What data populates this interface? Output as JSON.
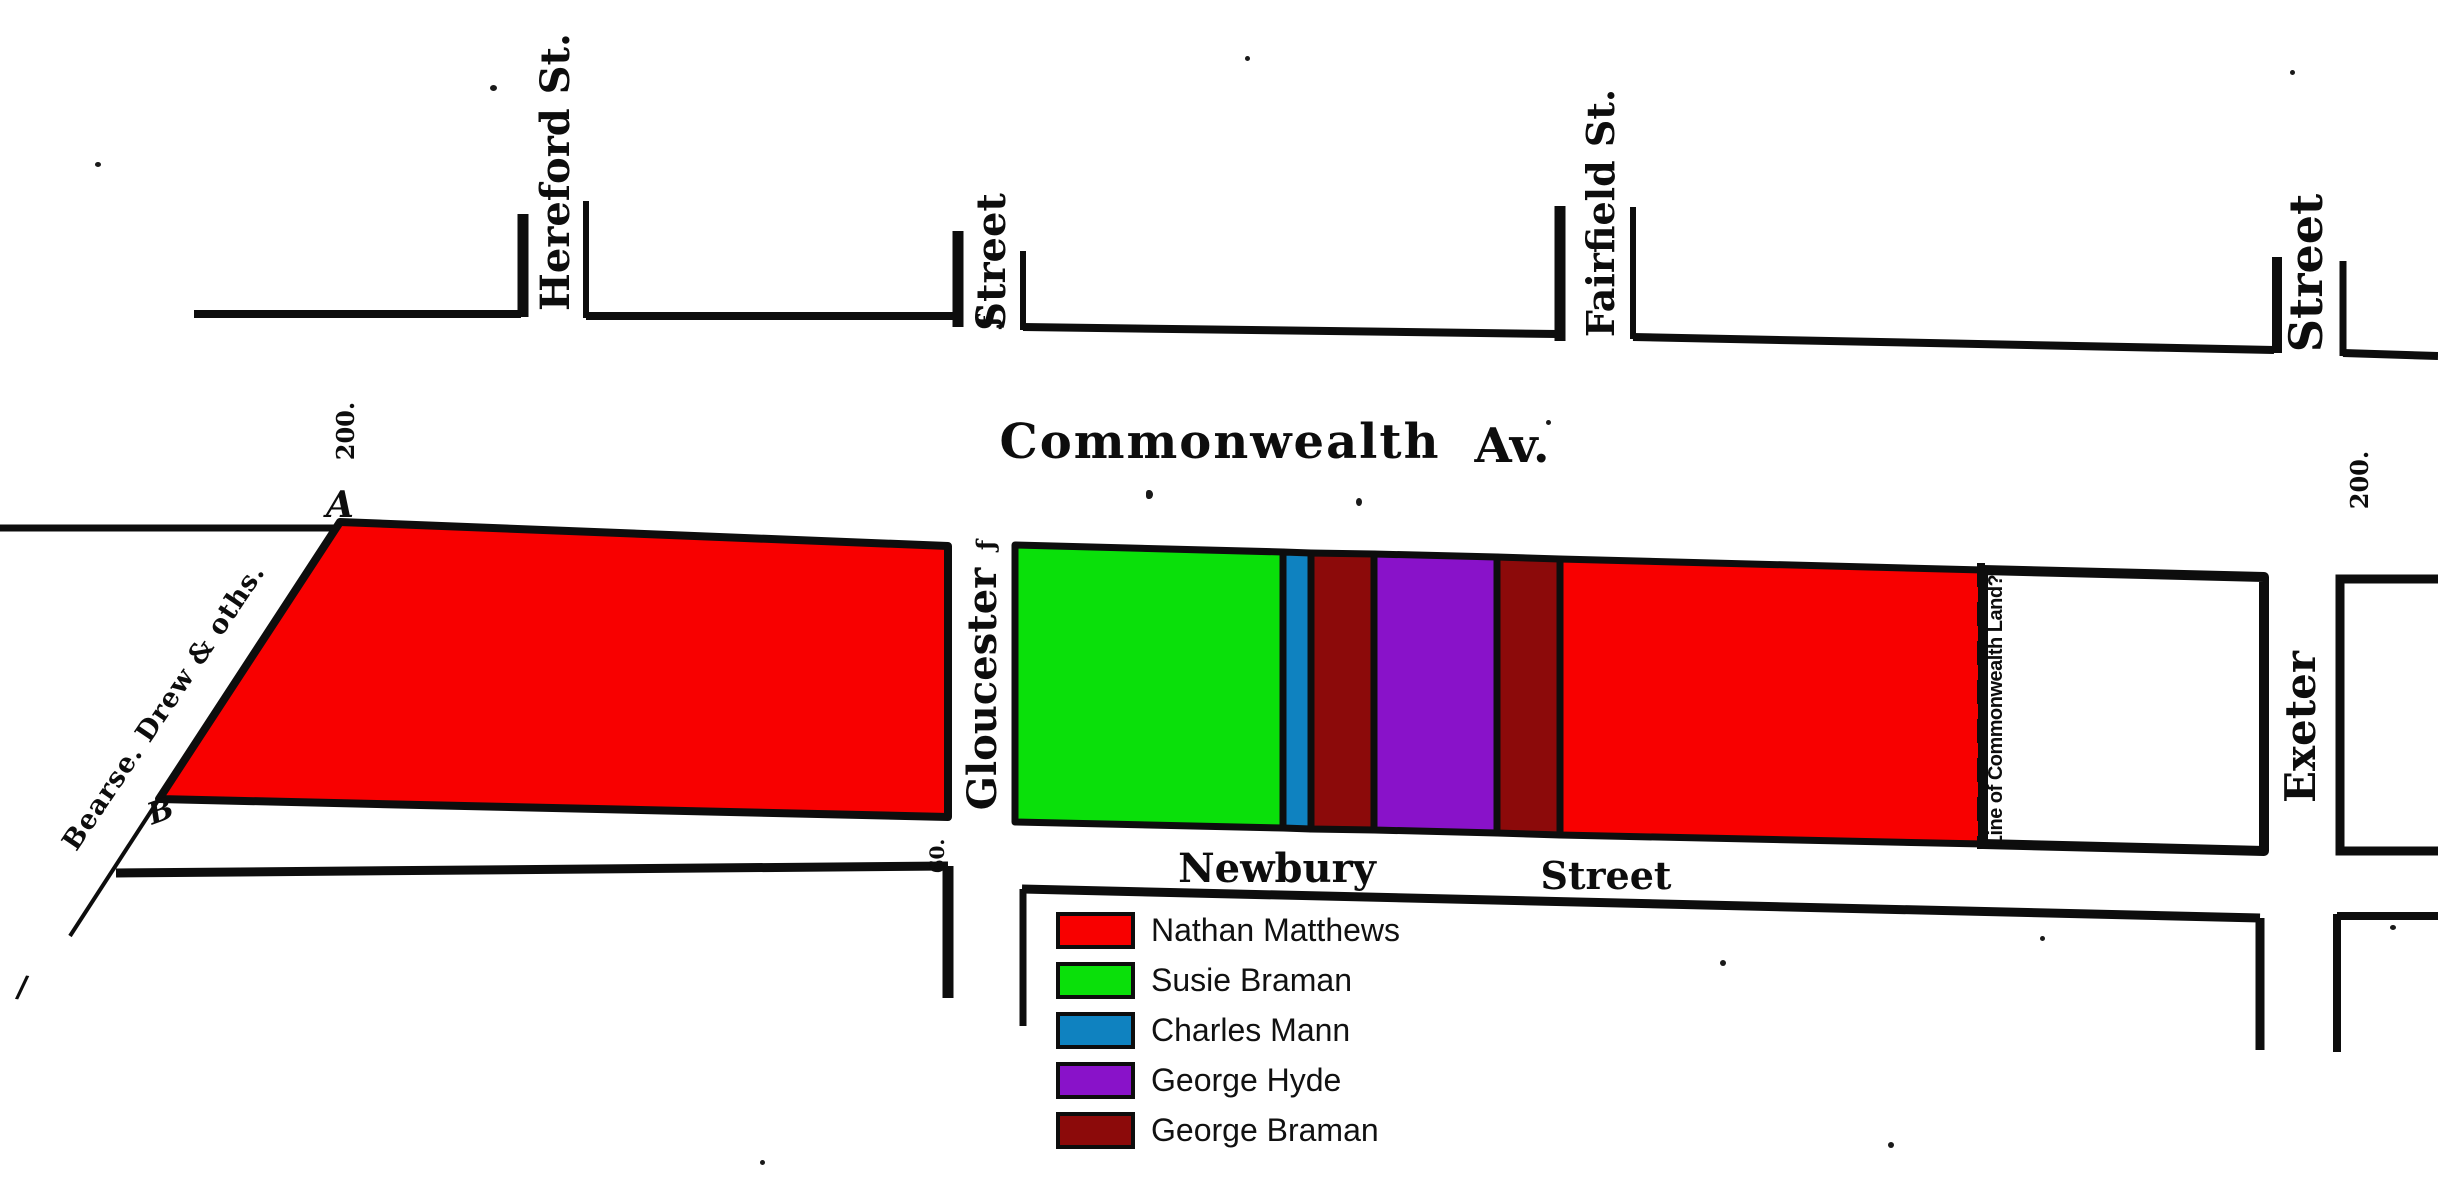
{
  "legend": {
    "items": [
      {
        "label": "Nathan Matthews",
        "color": "#f80000"
      },
      {
        "label": "Susie Braman",
        "color": "#0ae00a"
      },
      {
        "label": "Charles Mann",
        "color": "#0f82c0"
      },
      {
        "label": "George Hyde",
        "color": "#8912c9"
      },
      {
        "label": "George Braman",
        "color": "#8c0a0a"
      }
    ]
  },
  "map": {
    "ink_color": "#0d0d0d",
    "background": "#ffffff",
    "unassigned_color": "#ffffff",
    "streets": {
      "hereford": "Hereford St.",
      "street_top_mid": "Street",
      "fairfield": "Fairfield St.",
      "street_top_right": "Street",
      "commonwealth": "Commonwealth",
      "av": "Av.",
      "gloucester": "Gloucester",
      "exeter": "Exeter",
      "newbury": "Newbury",
      "street_newbury": "Street"
    },
    "annotations": {
      "bearse": "Bearse. Drew & oths.",
      "line_of_commonwealth": "Line of Commonwealth Land?",
      "dim_left": "200.",
      "dim_right": "200.",
      "point_a": "A",
      "point_b": "B",
      "mark_top": "ƒ",
      "mark_gloucester": "ƒ",
      "dim_small": "60.",
      "tick": "/"
    }
  }
}
